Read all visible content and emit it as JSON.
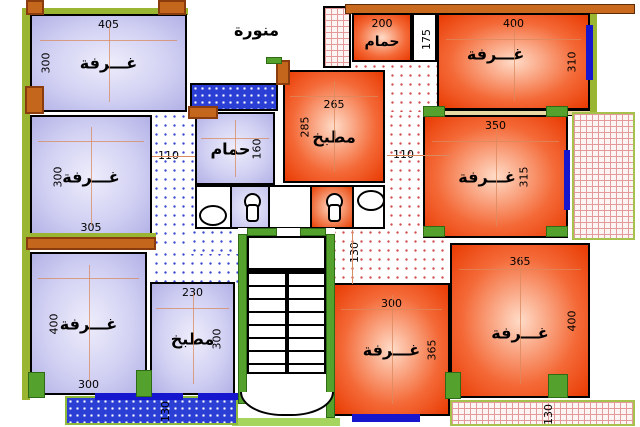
{
  "plan_type": "apartment-floor-plan",
  "rooms": {
    "top_left": {
      "label": "غـــرفة",
      "dim_top": "405",
      "dim_side": "300"
    },
    "mid_left": {
      "label": "غـــرفة",
      "dim_side": "300",
      "dim_bottom": "305"
    },
    "bottom_left": {
      "label": "غـــرفة",
      "dim_side": "400",
      "dim_bottom": "300"
    },
    "kitchen_bottom": {
      "label": "مطبخ",
      "dim_top": "230",
      "dim_side": "300"
    },
    "lightwell": {
      "label": "منورة"
    },
    "bath_mid": {
      "label": "حمام",
      "dim_side": "160"
    },
    "kitchen_top": {
      "label": "مطبخ",
      "dim_top": "265",
      "dim_side": "285"
    },
    "bath_top_right": {
      "label": "حمام",
      "dim_top": "200",
      "dim_side": "175"
    },
    "top_right": {
      "label": "غـــرفة",
      "dim_top": "400",
      "dim_side": "310"
    },
    "mid_right": {
      "label": "غـــرفة",
      "dim_top": "350",
      "dim_side": "315"
    },
    "bottom_mid": {
      "label": "غـــرفة",
      "dim_top": "300",
      "dim_side": "365"
    },
    "bottom_right": {
      "label": "غـــرفة",
      "dim_top": "365",
      "dim_side": "400"
    }
  },
  "dims": {
    "corridor_left": "110",
    "corridor_right": "110",
    "corridor_right_vertical": "130",
    "balcony_bottom_left": "130",
    "balcony_bottom_right": "130"
  },
  "icons": {
    "toilet": "toilet-top-view",
    "basin": "wash-basin-top-view"
  },
  "colors": {
    "room_blue": "#c9c8f0",
    "room_orange": "#e93a02",
    "wall_green": "#9ab531",
    "column_green": "#54a22d",
    "column_orange": "#c4661c",
    "window_blue": "#1616cf",
    "hatch_blue_dots": "#3a49d0",
    "hatch_red_dots": "#d05050",
    "balcony_blue": "#2b3fd4",
    "dimension_line": "#d98a5f"
  }
}
